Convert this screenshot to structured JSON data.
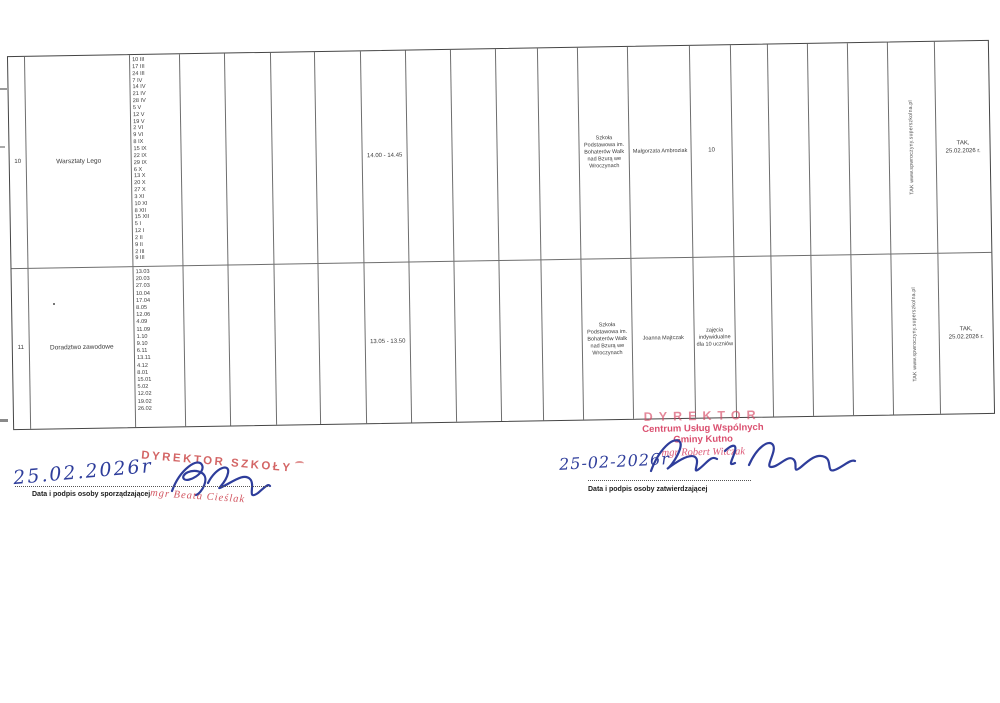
{
  "colors": {
    "ink_blue": "#2e3d9b",
    "stamp_red": "#d5486a",
    "table_line": "#6e6e6e"
  },
  "table": {
    "rows": [
      {
        "no": "10",
        "activity": "Warsztaty Lego",
        "dates": [
          "10 III",
          "17 III",
          "24 III",
          "7 IV",
          "14 IV",
          "21 IV",
          "28 IV",
          "5 V",
          "12 V",
          "19 V",
          "2 VI",
          "9 VI",
          "8 IX",
          "15 IX",
          "22 IX",
          "29 IX",
          "6 X",
          "13 X",
          "20 X",
          "27 X",
          "3 XI",
          "10 XI",
          "8 XII",
          "15 XII",
          "5 I",
          "12 I",
          "2 II",
          "9 II",
          "2 III",
          "9 III"
        ],
        "time": "14.00 - 14.45",
        "school": "Szkoła Podstawowa im. Bohaterów Walk nad Bzurą we Wroczynach",
        "teacher": "Małgorzata Ambroziak",
        "participants": "10",
        "website_confirm": "TAK www.spwroczyny.superszkolna.pl",
        "approval": "TAK,\n25.02.2026 r."
      },
      {
        "no": "11",
        "activity": "Doradztwo zawodowe",
        "dates": [
          "13.03",
          "20.03",
          "27.03",
          "10.04",
          "17.04",
          "8.05",
          "12.06",
          "4.09",
          "11.09",
          "1.10",
          "9.10",
          "6.11",
          "13.11",
          "4.12",
          "8.01",
          "15.01",
          "5.02",
          "12.02",
          "19.02",
          "26.02"
        ],
        "time": "13.05 - 13.50",
        "school": "Szkoła Podstawowa im. Bohaterów Walk nad Bzurą we Wroczynach",
        "teacher": "Joanna Majtczak",
        "participants": "zajęcia indywidualne dla 10 uczniów",
        "website_confirm": "TAK www.spwroczyny.superszkolna.pl",
        "approval": "TAK,\n25.02.2026 r."
      }
    ]
  },
  "signature_left": {
    "handwritten_date": "25.02.2026r",
    "stamp_title": "DYREKTOR SZKOŁY",
    "stamp_name": "mgr Beata Cieślak",
    "label": "Data i podpis osoby sporządzającej"
  },
  "signature_right": {
    "handwritten_date": "25-02-2026r",
    "stamp_title": "DYREKTOR",
    "stamp_org": "Centrum Usług Wspólnych",
    "stamp_unit": "Gminy Kutno",
    "stamp_name": "mgr Robert Witczak",
    "label": "Data i podpis osoby zatwierdzającej"
  }
}
